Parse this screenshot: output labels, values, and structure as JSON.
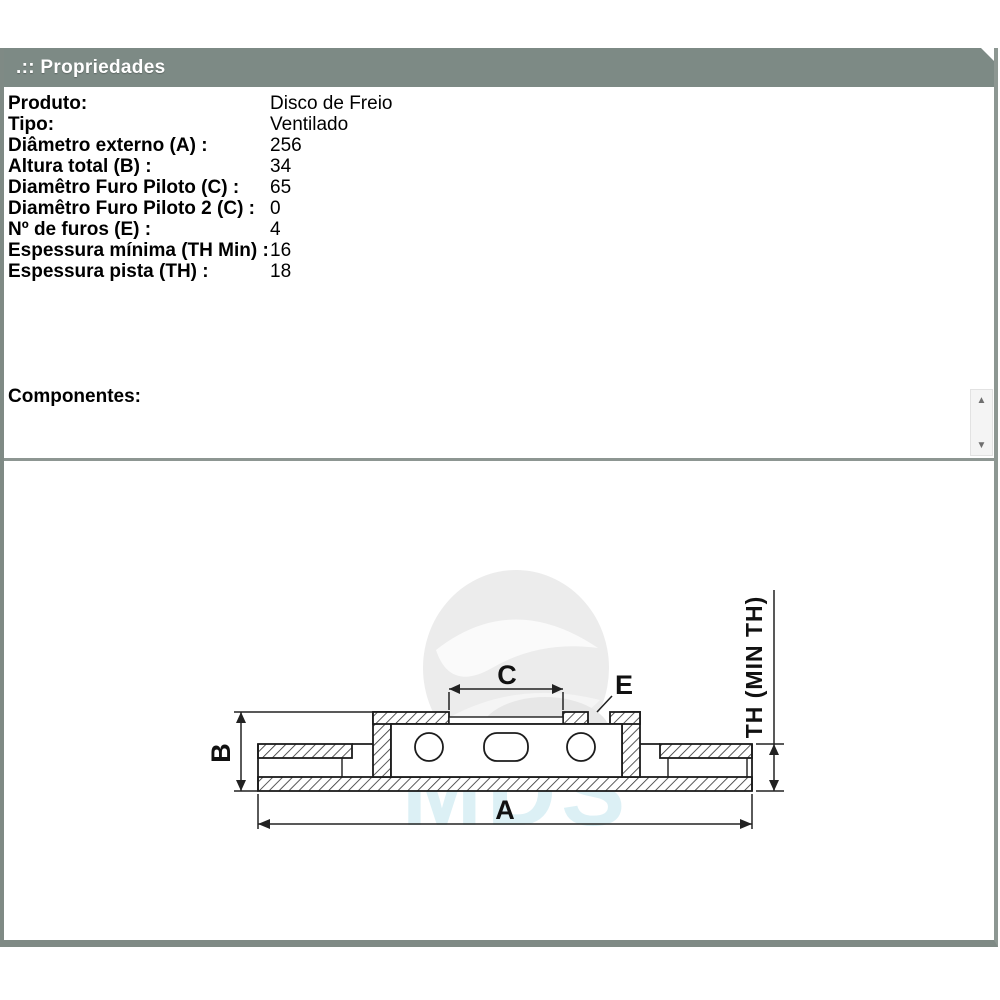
{
  "window": {
    "title": ".:: Propriedades"
  },
  "properties": {
    "rows": [
      {
        "label": "Produto:",
        "value": "Disco de Freio"
      },
      {
        "label": "Tipo:",
        "value": "Ventilado"
      },
      {
        "label": "Diâmetro externo (A) :",
        "value": "256"
      },
      {
        "label": "Altura total (B) :",
        "value": "34"
      },
      {
        "label": "Diamêtro Furo Piloto (C) :",
        "value": "65"
      },
      {
        "label": "Diamêtro Furo Piloto 2 (C) :",
        "value": "0"
      },
      {
        "label": "Nº de furos (E) :",
        "value": "4"
      },
      {
        "label": "Espessura mínima (TH Min) :",
        "value": "16"
      },
      {
        "label": "Espessura pista (TH) :",
        "value": "18"
      }
    ]
  },
  "components": {
    "label": "Componentes:"
  },
  "scrollbar": {
    "up_icon": "▲",
    "down_icon": "▼"
  },
  "diagram": {
    "labels": {
      "a": "A",
      "b": "B",
      "c": "C",
      "e": "E",
      "th": "TH (MIN TH)"
    },
    "watermark_text": "MDS"
  },
  "colors": {
    "header_gray": "#7d8a85",
    "border_gray": "#7f8a85",
    "watermark_blue": "#d6eef4",
    "line_black": "#1c1c1c"
  }
}
